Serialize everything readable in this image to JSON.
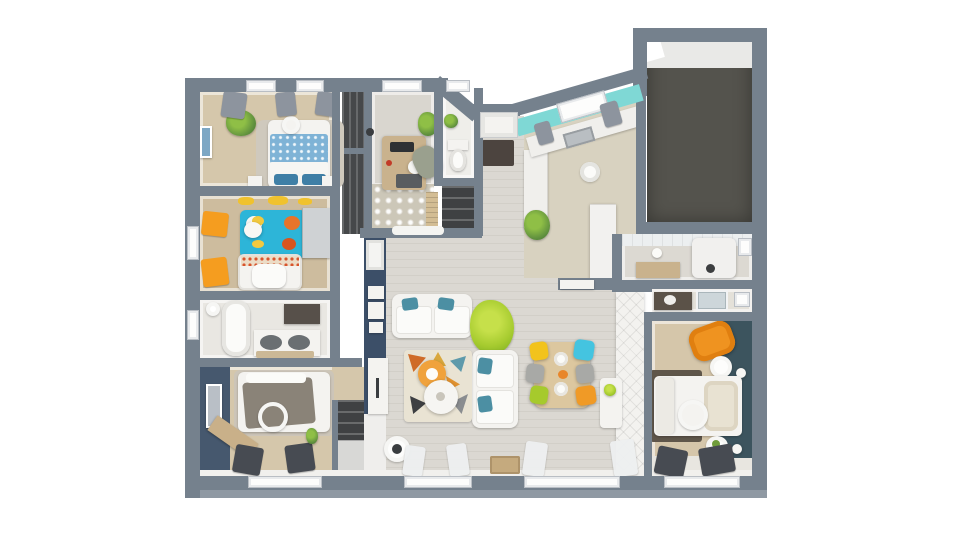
{
  "scene": {
    "type": "3D floor plan, top-down view of a single-storey house",
    "background": "#ffffff",
    "visible_text": "none"
  },
  "palette": {
    "wall": "#75818d",
    "wall_outer_face": "#8f99a3",
    "navy_accent_wall": "#3c4f68",
    "teal_accent_wall": "#3c545e",
    "turquoise_kitchen_wall": "#7fd8d5",
    "wood_floor": "#dbd8d2",
    "tan_floor": "#d5c7ab",
    "tile_floor": "#e9e7e2",
    "garage_floor": "#54534d",
    "orange": "#f09a26",
    "lime": "#a6ca2c",
    "cyan": "#44c4e0",
    "yellow": "#f2c31c",
    "teal_pillow": "#4c8fa3",
    "kids_rug_blue": "#2db5d8"
  },
  "rooms": [
    {
      "id": "bedroom-1",
      "name": "Bedroom 1 (top left): double bed with blue dotted duvet, blue pillows, rug, nightstands, plant, wall art, gray curtains on two windows"
    },
    {
      "id": "kids-bedroom",
      "name": "Kids bedroom: white crib with floral sheet, turquoise animal rug, orange curtains, wardrobe, pompom pendant, yellow wall decals"
    },
    {
      "id": "bathroom",
      "name": "Bathroom: bathtub, double vanity with two sinks, mirror, bath mat, window"
    },
    {
      "id": "bedroom-3",
      "name": "Bedroom 3 (bottom left): navy accent wall with mirror, bed with gray throw, ring pendant, wooden bench, dark curtains, window"
    },
    {
      "id": "office",
      "name": "Office: wooden desk, monitor, printer, desk lamp, office chair, plant, patterned tile floor, radiator"
    },
    {
      "id": "wc",
      "name": "WC: toilet, small plant"
    },
    {
      "id": "entry-hall",
      "name": "Entry hall: front door on recessed porch, doormat, ceiling light, shoe closet, wardrobe closet"
    },
    {
      "id": "kitchen",
      "name": "Kitchen: turquoise canted wall with window and gray curtains, sink counter, tall white units and fridge, base cabinets, ceiling light, plant"
    },
    {
      "id": "garage",
      "name": "Garage: dark concrete floor, white door zone at top"
    },
    {
      "id": "laundry",
      "name": "Laundry / utility room: water heater, wooden bench, tiled wall, small window, wall light"
    },
    {
      "id": "shower-room",
      "name": "Shower room: dark vanity with sink, glass shower, window"
    },
    {
      "id": "master-bedroom",
      "name": "Master bedroom: teal accent wall, orange armchair, bed with cream pillow stack, dark rug, ring pendant, round side tables, dark curtains, window"
    },
    {
      "id": "dressing",
      "name": "Dressing: tufted white wardrobe front, small white console with plant"
    },
    {
      "id": "living-dining",
      "name": "Living / dining room: two white sofas with teal pillows, mosaic rug, orange and white round coffee tables, lime green plant, wooden dining table with yellow, cyan, gray, lime and orange chairs, navy partition wall with door, shelves and cabinet, AC vent, floor lamp, doormat, white curtains, two windows"
    }
  ]
}
